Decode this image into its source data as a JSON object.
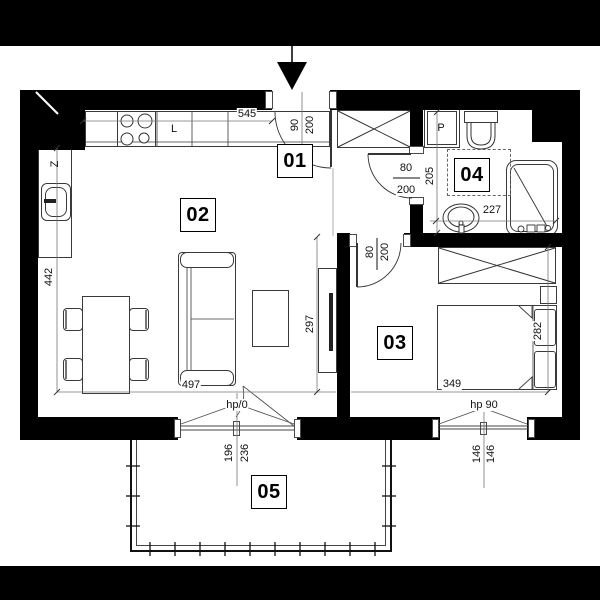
{
  "rooms": {
    "hall": "01",
    "living": "02",
    "bedroom": "03",
    "bath": "04",
    "balcony": "05"
  },
  "fixtures": {
    "fridge": "L",
    "kitchen_sink": "Z",
    "washer": "P"
  },
  "dims": {
    "kitchen_wall": "545",
    "entry_door_w": "90",
    "entry_door_h": "200",
    "bath_door_w": "80",
    "bath_door_h": "200",
    "bath_depth": "205",
    "bath_width": "227",
    "bed_door_w": "80",
    "bed_door_h": "200",
    "living_height": "442",
    "living_right_height": "297",
    "living_width": "497",
    "bedroom_width": "349",
    "bedroom_height": "282",
    "balcony_dim1": "196",
    "balcony_dim2": "236",
    "window_half1": "146",
    "window_half2": "146",
    "balcony_door_sill": "hp/0",
    "bedroom_window_sill": "hp 90"
  },
  "colors": {
    "wall": "#000000",
    "line": "#333333",
    "dimline": "#777777"
  }
}
